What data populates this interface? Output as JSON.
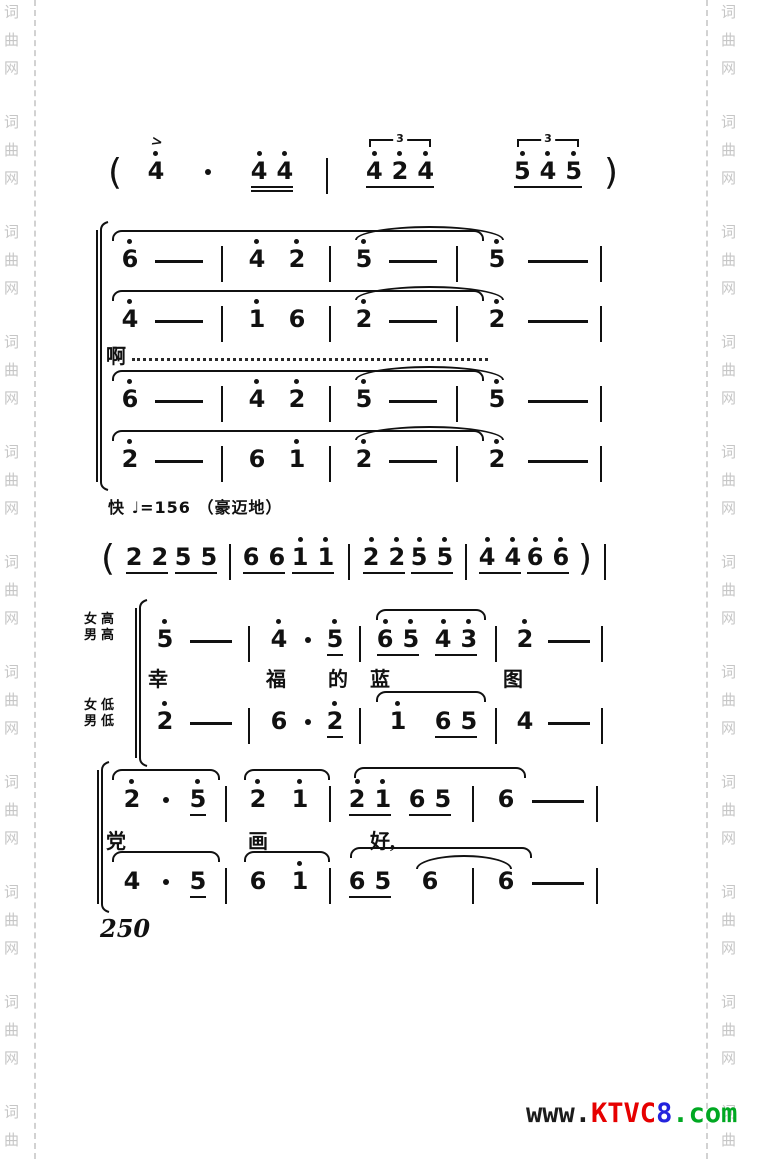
{
  "page_number": "250",
  "tempo_marking": "快 ♩=156 （豪迈地）",
  "voice_labels": {
    "upper": [
      "女高",
      "男高"
    ],
    "lower": [
      "女低",
      "男低"
    ]
  },
  "lyrics": {
    "vocalise": "啊",
    "phrase1": [
      "幸",
      "福",
      "的",
      "蓝",
      "图"
    ],
    "phrase2": [
      "党",
      "画",
      "好,"
    ]
  },
  "watermark": {
    "side_text": "词曲网",
    "bottom_logo": [
      {
        "text": "www.",
        "color": "#1c1c1c"
      },
      {
        "text": "KTVC",
        "color": "#e60000"
      },
      {
        "text": "8",
        "color": "#2323dd"
      },
      {
        "text": ".com",
        "color": "#00a822"
      }
    ]
  },
  "score": {
    "intro": [
      {
        "k": "p",
        "v": "("
      },
      {
        "k": "n",
        "v": "4",
        "d": 1,
        "a": 1
      },
      {
        "k": "d"
      },
      {
        "k": "g",
        "u": 2,
        "ns": [
          {
            "v": "4",
            "d": 1
          },
          {
            "v": "4",
            "d": 1
          }
        ]
      },
      {
        "k": "b"
      },
      {
        "k": "g",
        "u": 1,
        "t": 1,
        "ns": [
          {
            "v": "4",
            "d": 1
          },
          {
            "v": "2",
            "d": 1
          },
          {
            "v": "4",
            "d": 1
          }
        ]
      },
      {
        "k": "sp"
      },
      {
        "k": "g",
        "u": 1,
        "t": 1,
        "ns": [
          {
            "v": "5",
            "d": 1
          },
          {
            "v": "4",
            "d": 1
          },
          {
            "v": "5",
            "d": 1
          }
        ]
      },
      {
        "k": "p",
        "v": ")"
      }
    ],
    "system1": {
      "v1": [
        {
          "k": "n",
          "v": "6",
          "d": 1
        },
        {
          "k": "-"
        },
        {
          "k": "b"
        },
        {
          "k": "n",
          "v": "4",
          "d": 1
        },
        {
          "k": "n",
          "v": "2",
          "d": 1
        },
        {
          "k": "b"
        },
        {
          "k": "n",
          "v": "5",
          "d": 1
        },
        {
          "k": "-"
        },
        {
          "k": "b"
        },
        {
          "k": "n",
          "v": "5",
          "d": 1
        },
        {
          "k": "-"
        },
        {
          "k": "b"
        }
      ],
      "v2": [
        {
          "k": "n",
          "v": "4",
          "d": 1
        },
        {
          "k": "-"
        },
        {
          "k": "b"
        },
        {
          "k": "n",
          "v": "1",
          "d": 1
        },
        {
          "k": "n",
          "v": "6"
        },
        {
          "k": "b"
        },
        {
          "k": "n",
          "v": "2",
          "d": 1
        },
        {
          "k": "-"
        },
        {
          "k": "b"
        },
        {
          "k": "n",
          "v": "2",
          "d": 1
        },
        {
          "k": "-"
        },
        {
          "k": "b"
        }
      ],
      "v3": [
        {
          "k": "n",
          "v": "6",
          "d": 1
        },
        {
          "k": "-"
        },
        {
          "k": "b"
        },
        {
          "k": "n",
          "v": "4",
          "d": 1
        },
        {
          "k": "n",
          "v": "2",
          "d": 1
        },
        {
          "k": "b"
        },
        {
          "k": "n",
          "v": "5",
          "d": 1
        },
        {
          "k": "-"
        },
        {
          "k": "b"
        },
        {
          "k": "n",
          "v": "5",
          "d": 1
        },
        {
          "k": "-"
        },
        {
          "k": "b"
        }
      ],
      "v4": [
        {
          "k": "n",
          "v": "2",
          "d": 1
        },
        {
          "k": "-"
        },
        {
          "k": "b"
        },
        {
          "k": "n",
          "v": "6"
        },
        {
          "k": "n",
          "v": "1",
          "d": 1
        },
        {
          "k": "b"
        },
        {
          "k": "n",
          "v": "2",
          "d": 1
        },
        {
          "k": "-"
        },
        {
          "k": "b"
        },
        {
          "k": "n",
          "v": "2",
          "d": 1
        },
        {
          "k": "-"
        },
        {
          "k": "b"
        }
      ]
    },
    "interlude": [
      {
        "k": "p",
        "v": "("
      },
      {
        "k": "g",
        "u": 1,
        "ns": [
          {
            "v": "2"
          },
          {
            "v": "2"
          }
        ]
      },
      {
        "k": "g",
        "u": 1,
        "ns": [
          {
            "v": "5"
          },
          {
            "v": "5"
          }
        ]
      },
      {
        "k": "b"
      },
      {
        "k": "g",
        "u": 1,
        "ns": [
          {
            "v": "6"
          },
          {
            "v": "6"
          }
        ]
      },
      {
        "k": "g",
        "u": 1,
        "ns": [
          {
            "v": "1",
            "d": 1
          },
          {
            "v": "1",
            "d": 1
          }
        ]
      },
      {
        "k": "b"
      },
      {
        "k": "g",
        "u": 1,
        "ns": [
          {
            "v": "2",
            "d": 1
          },
          {
            "v": "2",
            "d": 1
          }
        ]
      },
      {
        "k": "g",
        "u": 1,
        "ns": [
          {
            "v": "5",
            "d": 1
          },
          {
            "v": "5",
            "d": 1
          }
        ]
      },
      {
        "k": "b"
      },
      {
        "k": "g",
        "u": 1,
        "ns": [
          {
            "v": "4",
            "d": 1
          },
          {
            "v": "4",
            "d": 1
          }
        ]
      },
      {
        "k": "g",
        "u": 1,
        "ns": [
          {
            "v": "6",
            "d": 1
          },
          {
            "v": "6",
            "d": 1
          }
        ]
      },
      {
        "k": "p",
        "v": ")"
      },
      {
        "k": "b"
      }
    ],
    "system2": {
      "v1": [
        {
          "k": "n",
          "v": "5",
          "d": 1
        },
        {
          "k": "-"
        },
        {
          "k": "b"
        },
        {
          "k": "n",
          "v": "4",
          "d": 1
        },
        {
          "k": "d"
        },
        {
          "k": "n",
          "v": "5",
          "d": 1,
          "u": 1
        },
        {
          "k": "b"
        },
        {
          "k": "g",
          "u": 1,
          "ns": [
            {
              "v": "6",
              "d": 1
            },
            {
              "v": "5",
              "d": 1
            }
          ]
        },
        {
          "k": "g",
          "u": 1,
          "ns": [
            {
              "v": "4",
              "d": 1
            },
            {
              "v": "3",
              "d": 1
            }
          ]
        },
        {
          "k": "b"
        },
        {
          "k": "n",
          "v": "2",
          "d": 1
        },
        {
          "k": "-"
        },
        {
          "k": "b"
        }
      ],
      "v2": [
        {
          "k": "n",
          "v": "2",
          "d": 1
        },
        {
          "k": "-"
        },
        {
          "k": "b"
        },
        {
          "k": "n",
          "v": "6"
        },
        {
          "k": "d"
        },
        {
          "k": "n",
          "v": "2",
          "d": 1,
          "u": 1
        },
        {
          "k": "b"
        },
        {
          "k": "n",
          "v": "1",
          "d": 1
        },
        {
          "k": "g",
          "u": 1,
          "ns": [
            {
              "v": "6"
            },
            {
              "v": "5"
            }
          ]
        },
        {
          "k": "b"
        },
        {
          "k": "n",
          "v": "4"
        },
        {
          "k": "-"
        },
        {
          "k": "b"
        }
      ]
    },
    "system3": {
      "v1": [
        {
          "k": "n",
          "v": "2",
          "d": 1
        },
        {
          "k": "d"
        },
        {
          "k": "n",
          "v": "5",
          "d": 1,
          "u": 1
        },
        {
          "k": "b"
        },
        {
          "k": "n",
          "v": "2",
          "d": 1
        },
        {
          "k": "n",
          "v": "1",
          "d": 1
        },
        {
          "k": "b"
        },
        {
          "k": "g",
          "u": 1,
          "ns": [
            {
              "v": "2",
              "d": 1
            },
            {
              "v": "1",
              "d": 1
            }
          ]
        },
        {
          "k": "g",
          "u": 1,
          "ns": [
            {
              "v": "6"
            },
            {
              "v": "5"
            }
          ]
        },
        {
          "k": "b"
        },
        {
          "k": "n",
          "v": "6"
        },
        {
          "k": "-"
        },
        {
          "k": "b"
        }
      ],
      "v2": [
        {
          "k": "n",
          "v": "4"
        },
        {
          "k": "d"
        },
        {
          "k": "n",
          "v": "5",
          "u": 1
        },
        {
          "k": "b"
        },
        {
          "k": "n",
          "v": "6"
        },
        {
          "k": "n",
          "v": "1",
          "d": 1
        },
        {
          "k": "b"
        },
        {
          "k": "g",
          "u": 1,
          "ns": [
            {
              "v": "6"
            },
            {
              "v": "5"
            }
          ]
        },
        {
          "k": "n",
          "v": "6"
        },
        {
          "k": "b"
        },
        {
          "k": "n",
          "v": "6"
        },
        {
          "k": "-"
        },
        {
          "k": "b"
        }
      ]
    }
  }
}
